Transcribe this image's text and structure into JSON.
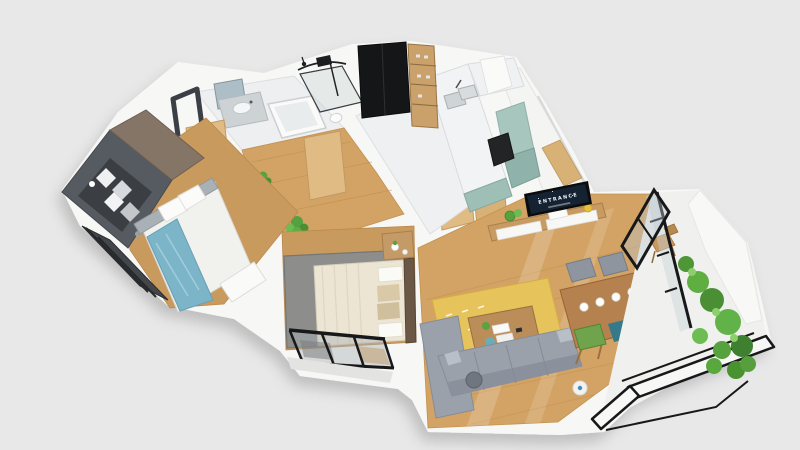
{
  "scene": {
    "description": "isometric 3d render of an apartment floor plan on a gray background",
    "background": "#e8e8e8"
  },
  "tv": {
    "label": "ENTRANCE"
  },
  "rooms": [
    "bathroom",
    "hallway",
    "bedroom",
    "master-bedroom",
    "kitchen",
    "entrance",
    "living-room",
    "dining-area",
    "master-balcony",
    "living-balcony"
  ],
  "colors": {
    "background": "#e8e8e8",
    "wall": "#f7f7f5",
    "wall_shade": "#e0e0de",
    "wood_floor": "#d3a365",
    "wood_floor_dark": "#c99a5d",
    "tile": "#edeff1",
    "frame_black": "#17181a",
    "cabinet_teal": "#9dbfb6",
    "counter_marble": "#f2f3f5",
    "appliance_black": "#151617",
    "wardrobe_slate": "#565b61",
    "wardrobe_taupe": "#857567",
    "sofa_gray": "#9aa1ab",
    "rug_gray": "#8d8d8b",
    "rug_yellow": "#e7c35c",
    "bed_cream": "#ece5d3",
    "bed_blue": "#7db5c8",
    "table_wood": "#b5824f",
    "chair_green": "#6fa34c",
    "chair_teal": "#35798b",
    "door_wood": "#e0bb83",
    "plant_green": "#58a23e",
    "tv_screen": "#142231"
  }
}
